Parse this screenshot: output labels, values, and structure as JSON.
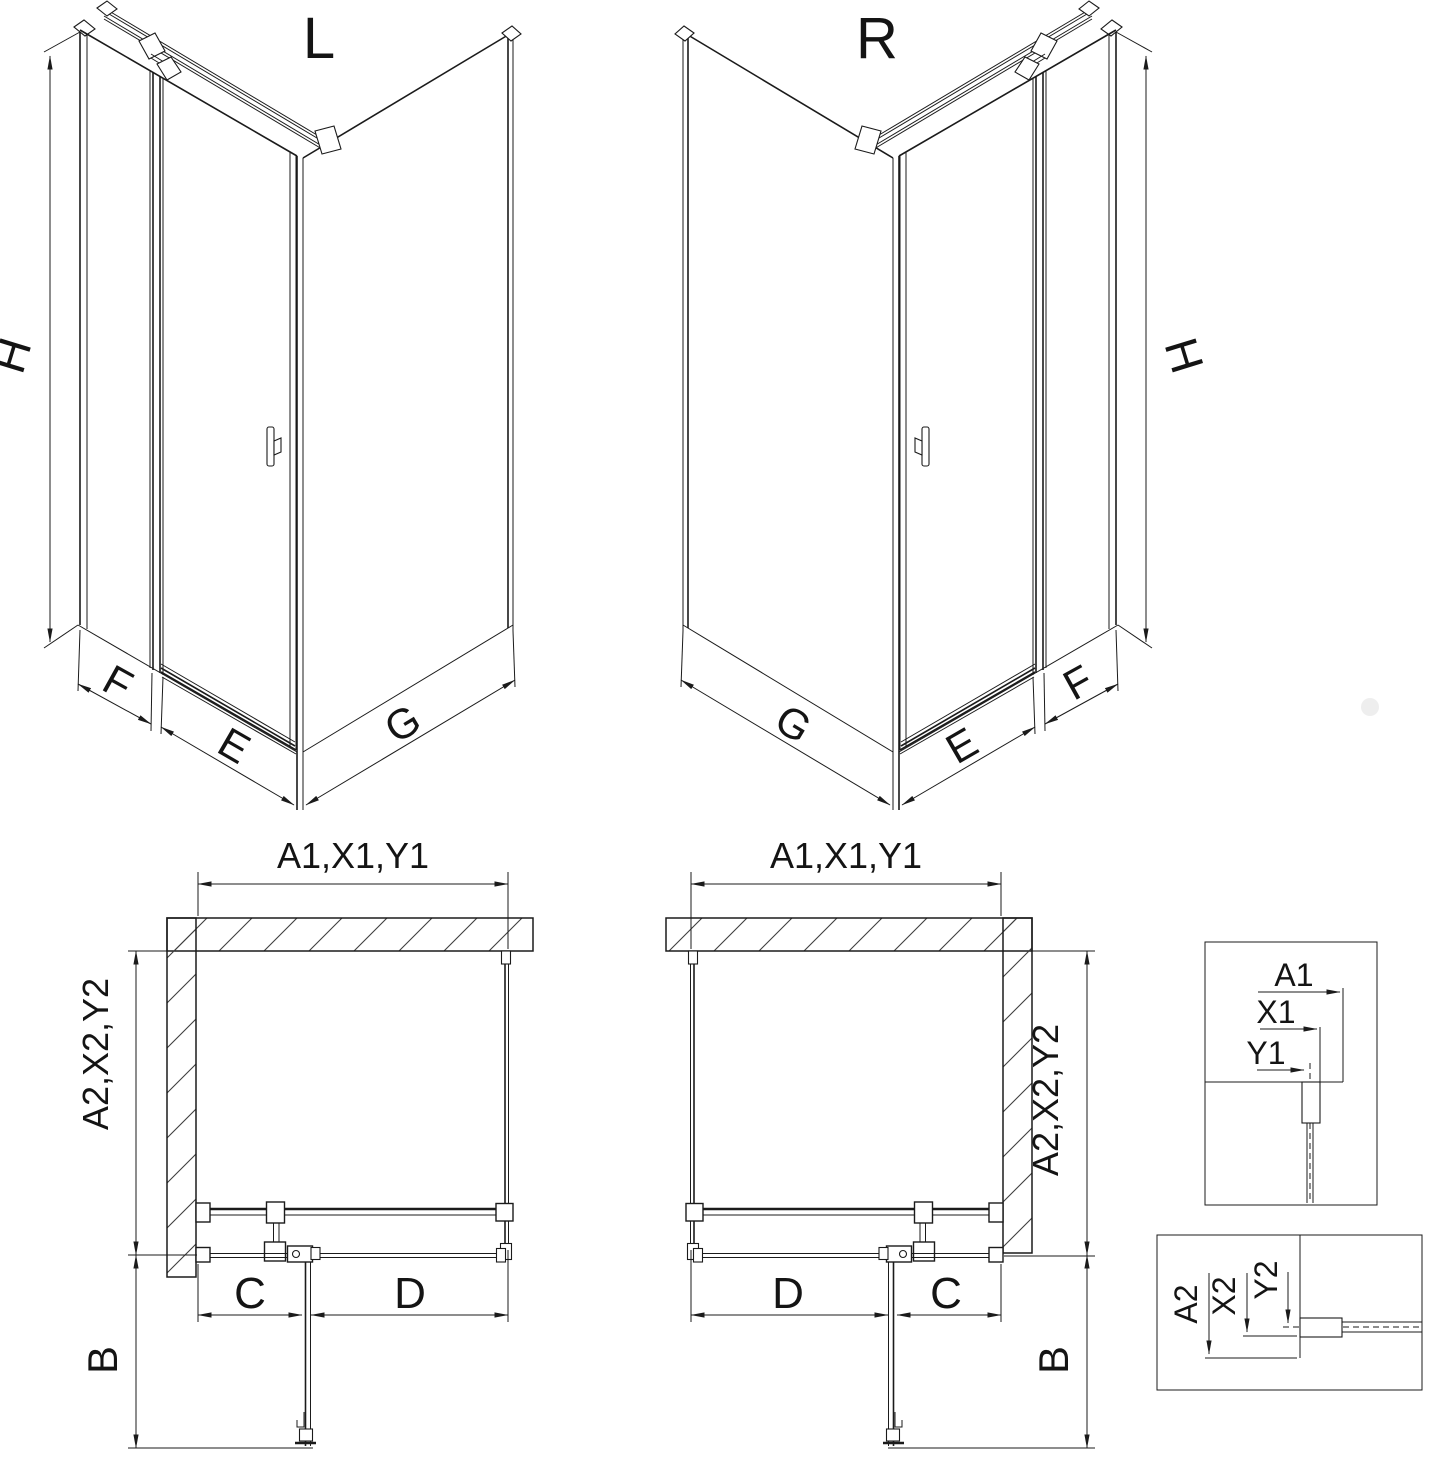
{
  "views": {
    "iso_left": {
      "label": "L",
      "dim_height": "H",
      "dim_side_panel": "F",
      "dim_door": "E",
      "dim_return_panel": "G"
    },
    "iso_right": {
      "label": "R",
      "dim_height": "H",
      "dim_side_panel": "F",
      "dim_door": "E",
      "dim_return_panel": "G"
    },
    "plan_left": {
      "dim_width": "A1,X1,Y1",
      "dim_depth": "A2,X2,Y2",
      "dim_door_swing": "B",
      "dim_fixed_segment": "C",
      "dim_panel_segment": "D"
    },
    "plan_right": {
      "dim_width": "A1,X1,Y1",
      "dim_depth": "A2,X2,Y2",
      "dim_door_swing": "B",
      "dim_fixed_segment": "C",
      "dim_panel_segment": "D"
    },
    "detail_width": {
      "dims": [
        "A1",
        "X1",
        "Y1"
      ]
    },
    "detail_depth": {
      "dims": [
        "A2",
        "X2",
        "Y2"
      ]
    }
  },
  "colors": {
    "line": "#1b1b1b",
    "hatch": "#3f3f3f",
    "background": "#ffffff",
    "watermark_dot": "#eaeaea"
  }
}
